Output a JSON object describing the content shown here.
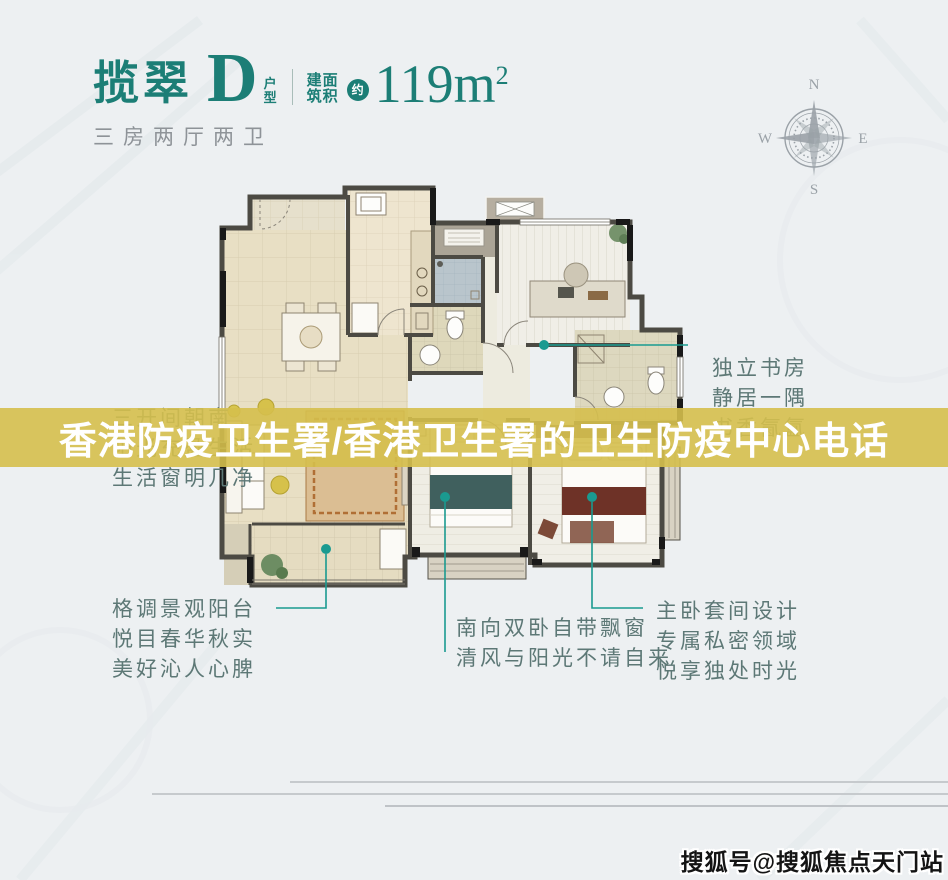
{
  "header": {
    "project_name": "揽翠",
    "unit_letter": "D",
    "unit_type_chars": [
      "户",
      "型"
    ],
    "area_label_row1": "建面",
    "area_label_row2": "筑积",
    "approx_badge": "约",
    "area_value": "119m",
    "area_exponent": "2",
    "subtitle": "三房两厅两卫",
    "accent_color": "#1c7e76"
  },
  "compass": {
    "north": "N",
    "east": "E",
    "south": "S",
    "west": "W"
  },
  "overlay_banner": {
    "text": "香港防疫卫生署/香港卫生署的卫生防疫中心电话",
    "bg_color": "#d5bf4c",
    "text_color": "#ffffff"
  },
  "floorplan_annotations": {
    "text_color": "#5d7876",
    "leader_color": "#1a9a90",
    "south_window": {
      "lines": [
        "三开间朝南",
        "阳光充盈生活",
        "生活窗明几净"
      ]
    },
    "study": {
      "lines": [
        "独立书房",
        "静居一隅",
        "书香氤氲"
      ]
    },
    "view_balcony": {
      "lines": [
        "格调景观阳台",
        "悦目春华秋实",
        "美好沁人心脾"
      ]
    },
    "south_bedrooms": {
      "lines": [
        "南向双卧自带飘窗",
        "清风与阳光不请自来"
      ]
    },
    "master_suite": {
      "lines": [
        "主卧套间设计",
        "专属私密领域",
        "悦享独处时光"
      ]
    }
  },
  "watermark": {
    "text": "搜狐号@搜狐焦点天门站"
  }
}
